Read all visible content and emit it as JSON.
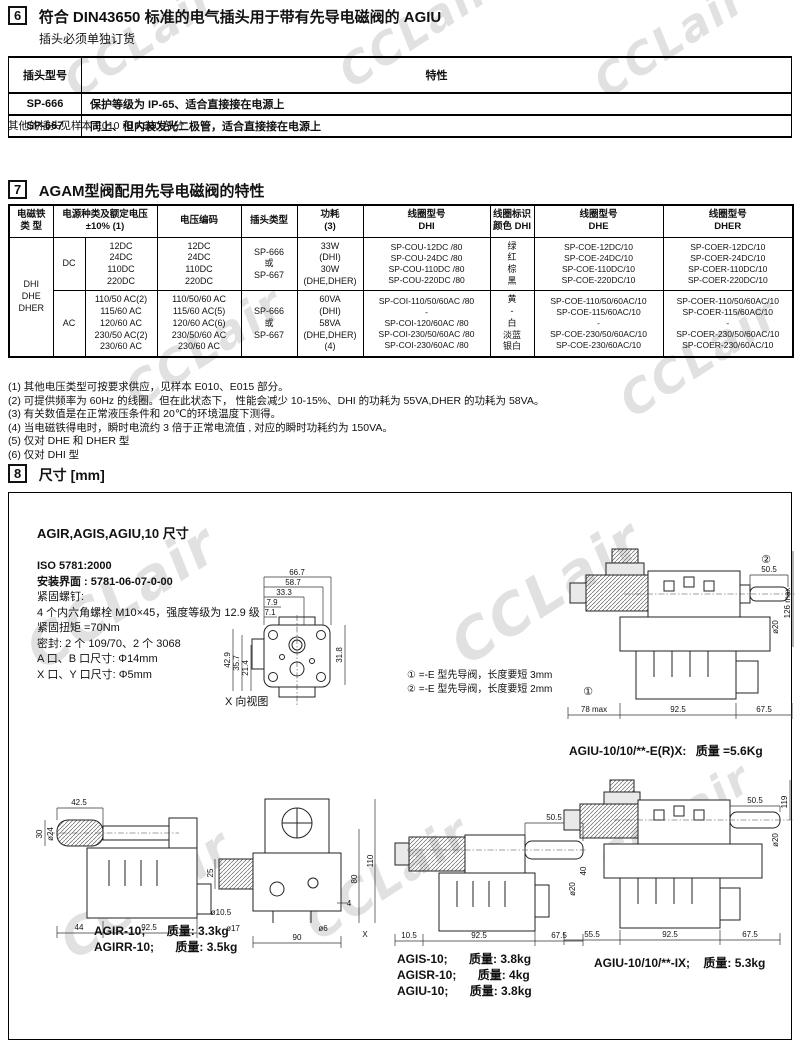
{
  "watermark_text": "CCLair",
  "section6": {
    "num": "6",
    "title": "符合 DIN43650 标准的电气插头用于带有先导电磁阀的 AGIU",
    "subtitle": "插头必须单独订货",
    "col_model": "插头型号",
    "col_feature": "特性",
    "rows": [
      {
        "model": "SP-666",
        "feature": "保护等级为 IP-65、适合直接接在电源上"
      },
      {
        "model": "SP-667",
        "feature": "同上、但内装发光二极管，适合直接接在电源上"
      }
    ],
    "footnote": "其他的插头见样本 E010 和 K500 部分"
  },
  "section7": {
    "num": "7",
    "title": "AGAM型阀配用先导电磁阀的特性",
    "headers": {
      "type": "电磁铁\n类 型",
      "supply": "电源种类及额定电压\n±10% (1)",
      "code": "电压编码",
      "plug": "插头类型",
      "power": "功耗\n(3)",
      "coil_dhi": "线圈型号\nDHI",
      "color_dhi": "线圈标识\n颜色 DHI",
      "coil_dhe": "线圈型号\nDHE",
      "coil_dher": "线圈型号\nDHER"
    },
    "type_cell": "DHI\nDHE\nDHER",
    "dc": {
      "src": "DC",
      "voltages": "12DC\n24DC\n110DC\n220DC",
      "codes": "12DC\n24DC\n110DC\n220DC",
      "plug": "SP-666\n或\nSP-667",
      "power": "33W\n(DHI)\n30W\n(DHE,DHER)",
      "coil_dhi": "SP-COU-12DC /80\nSP-COU-24DC /80\nSP-COU-110DC /80\nSP-COU-220DC /80",
      "colors": "绿\n红\n棕\n黑",
      "coil_dhe": "SP-COE-12DC/10\nSP-COE-24DC/10\nSP-COE-110DC/10\nSP-COE-220DC/10",
      "coil_dher": "SP-COER-12DC/10\nSP-COER-24DC/10\nSP-COER-110DC/10\nSP-COER-220DC/10"
    },
    "ac": {
      "src": "AC",
      "voltages": "110/50 AC(2)\n115/60 AC\n120/60 AC\n230/50 AC(2)\n230/60 AC",
      "codes": "110/50/60 AC\n115/60 AC(5)\n120/60 AC(6)\n230/50/60 AC\n230/60 AC",
      "plug": "SP-666\n或\nSP-667",
      "power": "60VA\n(DHI)\n58VA\n(DHE,DHER)\n(4)",
      "coil_dhi": "SP-COI-110/50/60AC /80\n-\nSP-COI-120/60AC /80\nSP-COI-230/50/60AC /80\nSP-COI-230/60AC /80",
      "colors": "黄\n-\n白\n淡蓝\n银白",
      "coil_dhe": "SP-COE-110/50/60AC/10\nSP-COE-115/60AC/10\n-\nSP-COE-230/50/60AC/10\nSP-COE-230/60AC/10",
      "coil_dher": "SP-COER-110/50/60AC/10\nSP-COER-115/60AC/10\n-\nSP-COER-230/50/60AC/10\nSP-COER-230/60AC/10"
    }
  },
  "footnotes": [
    "(1) 其他电压类型可按要求供应，见样本 E010、E015 部分。",
    "(2) 可提供频率为 60Hz 的线圈。但在此状态下， 性能会减少 10-15%、DHI 的功耗为 55VA,DHER 的功耗为 58VA。",
    "(3) 有关数值是在正常液压条件和 20℃的环境温度下测得。",
    "(4) 当电磁铁得电时，瞬时电流约 3 倍于正常电流值 , 对应的瞬时功耗约为 150VA。",
    "(5) 仅对 DHE 和 DHER 型",
    "(6) 仅对 DHI 型"
  ],
  "section8": {
    "num": "8",
    "title": "尺寸 [mm]",
    "boxtitle": "AGIR,AGIS,AGIU,10 尺寸",
    "specs": [
      "ISO 5781:2000",
      "安装界面 : 5781-06-07-0-00",
      "紧固螺钉:",
      "4 个内六角螺栓 M10×45，强度等级为 12.9 级",
      "紧固扭矩 =70Nm",
      "密封: 2 个 109/70、2 个 3068",
      "A 口、B 口尺寸: Φ14mm",
      "X 口、Y 口尺寸: Φ5mm"
    ],
    "view_label": "X 向视图",
    "notes": [
      "① =-E 型先导阀，长度要短 3mm",
      "② =-E 型先导阀，长度要短 2mm"
    ],
    "dims": {
      "iface": {
        "d1": "66.7",
        "d2": "58.7",
        "d3": "33.3",
        "d4": "7.9",
        "d5": "7.1",
        "l1": "42.9",
        "l2": "35.7",
        "l3": "21.4",
        "r1": "31.8"
      },
      "erx": {
        "top": "50.5",
        "h": "126 max",
        "dia": "ø20",
        "b1": "78 max",
        "b2": "92.5",
        "b3": "67.5",
        "m1": "①",
        "m2": "②"
      },
      "agir": {
        "top": "42.5",
        "l1": "30",
        "dia": "ø24",
        "b1": "44",
        "b2": "92.5"
      },
      "front": {
        "r1": "110",
        "r2": "80",
        "l1": "25",
        "dia1": "ø10.5",
        "dia2": "ø17",
        "dia3": "ø6",
        "x": "X",
        "n4": "4",
        "b1": "90"
      },
      "side": {
        "top": "50.5",
        "r1": "40",
        "dia": "ø20",
        "b1": "10.5",
        "b2": "92.5",
        "b3": "67.5"
      },
      "ix": {
        "top": "50.5",
        "r1": "119",
        "dia": "ø20",
        "b1": "55.5",
        "b2": "92.5",
        "b3": "67.5"
      }
    },
    "labels": {
      "erx_model": "AGIU-10/10/**-E(R)X:",
      "erx_mass": "质量 =5.6Kg",
      "agir": [
        {
          "m": "AGIR-10;",
          "w": "质量: 3.3kg"
        },
        {
          "m": "AGIRR-10;",
          "w": "质量: 3.5kg"
        }
      ],
      "agis": [
        {
          "m": "AGIS-10;",
          "w": "质量: 3.8kg"
        },
        {
          "m": "AGISR-10;",
          "w": "质量: 4kg"
        },
        {
          "m": "AGIU-10;",
          "w": "质量: 3.8kg"
        }
      ],
      "ix_model": "AGIU-10/10/**-IX;",
      "ix_mass": "质量: 5.3kg"
    }
  }
}
